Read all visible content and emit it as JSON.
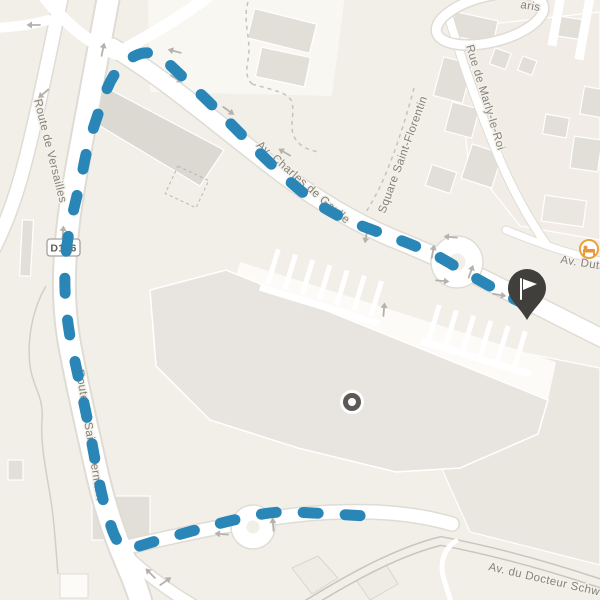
{
  "map": {
    "labels": {
      "route_de_versailles": "Route de Versailles",
      "d186_badge": "D186",
      "route_de_saint_germain": "Route de Saint-Germain",
      "av_charles_de_gaulle": "Av. Charles de Gaulle",
      "square_saint_florentin": "Square Saint-Florentin",
      "rue_de_marly_le_roi": "Rue de Marly-le-Roi",
      "paris_partial": "aris",
      "av_dutartre": "Av. Dutartre",
      "av_du_docteur": "Av. du Docteur Schweitzer"
    },
    "colors": {
      "background": "#f2eee8",
      "road": "#ffffff",
      "building": "#e2dfd8",
      "route_line": "#2b86b8",
      "finish_pin": "#403f3c",
      "waypoint_dot": "#5b5955",
      "poi_accent": "#e8a33c",
      "label_text": "#85827b"
    },
    "markers": {
      "finish_flag": "flag-icon",
      "waypoint": "dot-icon",
      "hotel_poi": "bed-icon"
    },
    "route_style": {
      "dash": "capsule",
      "dash_color": "#2b86b8"
    }
  }
}
